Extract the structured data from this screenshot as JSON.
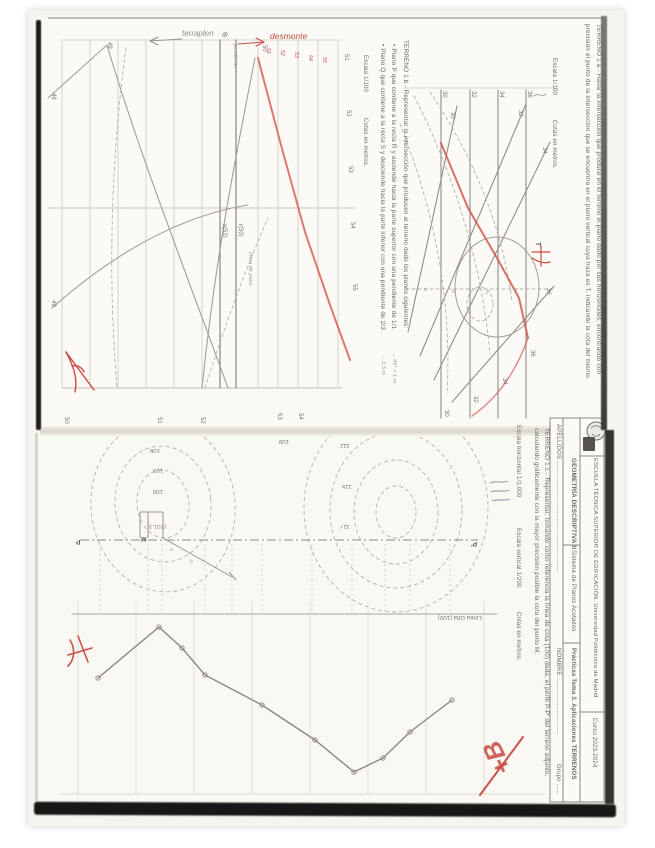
{
  "document": {
    "course_header": {
      "school": "ESCUELA TÉCNICA SUPERIOR DE EDIFICACIÓN. Universidad Politécnica de Madrid",
      "curso": "Curso 2023-2024",
      "subject": "GEOMETRÍA DESCRIPTIVA II",
      "system": "Sistema de Planos Acotados",
      "practice": "Prácticas Tema 3. Aplicaciones TERRENOS",
      "apellidos": "APELLIDOS ............................................................",
      "nombre": "NOMBRE ..............................",
      "grupo": "Grupo ......"
    },
    "terreno_1a": {
      "line1": "TERRENO 1.a.- Hallar la intersección que produce en el terreno el plano dado por sus horizontales, encontrando con",
      "line2": "precisión el punto de la intersección que se encuentra en el plano vertical cuya traza es T, indicando la cota del mismo.",
      "escala": "Escala 1/100",
      "cotas": "Cotas en metros."
    },
    "terreno_1b": {
      "title": "TERRENO 1.b.- Representar la intersección que producen al terreno dado los planos siguientes:",
      "bullet1": "•    Plano P que contiene a la recta R y asciende hacia la parte superior con una pendiente de 1/1",
      "bullet1_note": "→ 45° = 1 m",
      "bullet2": "•    Plano Q que contiene a la recta S y desciende hacia la parte inferior con una pendiente de 2/3",
      "bullet2_note": "→ 1,5 m",
      "escala": "Escala 1/100",
      "cotas": "Cotas en metros."
    },
    "terreno_1c": {
      "line1": "TERRENO 1.c.- Representar, tomando como referencia la línea de cota (100) dada, el perfil P-P' del terreno adjunto,",
      "line2": "calculando gráficamente con la mayor precisión posible la cota del punto M.",
      "escala_h": "Escala horizontal 1/1.000",
      "escala_v": "Escala vertical 1/200",
      "cotas": "Cotas en metros."
    },
    "handwriting": {
      "terraplen": "terraplen",
      "desmonte": "desmonte",
      "grade": "+B"
    },
    "colors": {
      "red_ink": "#c94a41",
      "pencil": "#9a948b",
      "print": "#6e6a63",
      "paper": "#f8f7f2"
    },
    "labels": [
      {
        "t": "48",
        "x": 56,
        "y": 93,
        "c": "v5"
      },
      {
        "t": "49",
        "x": 56,
        "y": 300,
        "c": "v5"
      },
      {
        "t": "49",
        "x": 112,
        "y": 42,
        "c": "v5"
      },
      {
        "t": "50",
        "x": 267,
        "y": 45,
        "c": "v5"
      },
      {
        "t": "51",
        "x": 349,
        "y": 54,
        "c": "v5"
      },
      {
        "t": "52",
        "x": 351,
        "y": 110,
        "c": "v5"
      },
      {
        "t": "53",
        "x": 353,
        "y": 166,
        "c": "v5"
      },
      {
        "t": "54",
        "x": 355,
        "y": 222,
        "c": "v5"
      },
      {
        "t": "55",
        "x": 357,
        "y": 284,
        "c": "v5"
      },
      {
        "t": "50",
        "x": 69,
        "y": 417,
        "c": "v5"
      },
      {
        "t": "51",
        "x": 162,
        "y": 417,
        "c": "v5"
      },
      {
        "t": "52",
        "x": 205,
        "y": 417,
        "c": "v5"
      },
      {
        "t": "53",
        "x": 282,
        "y": 413,
        "c": "v5"
      },
      {
        "t": "54",
        "x": 303,
        "y": 413,
        "c": "v5"
      },
      {
        "t": "s(52)",
        "x": 227,
        "y": 224,
        "c": "v5",
        "n": "line-s52-label"
      },
      {
        "t": "r(50)",
        "x": 243,
        "y": 224,
        "c": "v5",
        "n": "line-r50-label"
      },
      {
        "t": "51",
        "x": 270,
        "y": 48,
        "c": "vr"
      },
      {
        "t": "52",
        "x": 284,
        "y": 50,
        "c": "vr"
      },
      {
        "t": "53",
        "x": 298,
        "y": 52,
        "c": "vr"
      },
      {
        "t": "54",
        "x": 312,
        "y": 55,
        "c": "vr"
      },
      {
        "t": "55",
        "x": 326,
        "y": 57,
        "c": "vr"
      },
      {
        "t": "30",
        "x": 447,
        "y": 91,
        "c": "v5"
      },
      {
        "t": "32",
        "x": 476,
        "y": 91,
        "c": "v5"
      },
      {
        "t": "34",
        "x": 504,
        "y": 91,
        "c": "v5"
      },
      {
        "t": "36",
        "x": 532,
        "y": 91,
        "c": "v5"
      },
      {
        "t": "30",
        "x": 455,
        "y": 112,
        "c": "v5"
      },
      {
        "t": "32",
        "x": 523,
        "y": 110,
        "c": "v5"
      },
      {
        "t": "34",
        "x": 547,
        "y": 147,
        "c": "v5"
      },
      {
        "t": "36",
        "x": 551,
        "y": 288,
        "c": "v5"
      },
      {
        "t": "36",
        "x": 535,
        "y": 350,
        "c": "v5"
      },
      {
        "t": "34",
        "x": 507,
        "y": 378,
        "c": "v5"
      },
      {
        "t": "32",
        "x": 478,
        "y": 396,
        "c": "v5"
      },
      {
        "t": "30",
        "x": 449,
        "y": 410,
        "c": "v5"
      },
      {
        "t": "T",
        "x": 541,
        "y": 242,
        "c": "vb",
        "n": "trace-t-label"
      },
      {
        "t": "a'",
        "x": 424,
        "y": 288,
        "c": "t5"
      },
      {
        "t": "b'",
        "x": 452,
        "y": 290,
        "c": "t5"
      },
      {
        "t": "c'",
        "x": 486,
        "y": 291,
        "c": "t5"
      },
      {
        "t": "d'",
        "x": 514,
        "y": 289,
        "c": "t5"
      },
      {
        "t": "106",
        "x": 150,
        "y": 447,
        "c": "r1",
        "n": "contour-label"
      },
      {
        "t": "103",
        "x": 153,
        "y": 467,
        "c": "r1",
        "n": "contour-label"
      },
      {
        "t": "100",
        "x": 153,
        "y": 488,
        "c": "r1",
        "n": "contour-label"
      },
      {
        "t": "109",
        "x": 279,
        "y": 438,
        "c": "r1",
        "n": "contour-label"
      },
      {
        "t": "112",
        "x": 340,
        "y": 442,
        "c": "r1",
        "n": "contour-label"
      },
      {
        "t": "115",
        "x": 342,
        "y": 483,
        "c": "r1",
        "n": "contour-label"
      },
      {
        "t": "117",
        "x": 340,
        "y": 523,
        "c": "r1",
        "n": "contour-label"
      },
      {
        "t": "P",
        "x": 76,
        "y": 537,
        "c": "r1b",
        "n": "point-p-label"
      },
      {
        "t": "P'",
        "x": 471,
        "y": 539,
        "c": "r1b",
        "n": "point-p-prime-label"
      },
      {
        "t": "M",
        "x": 141,
        "y": 534,
        "c": "r1b",
        "n": "point-m-label"
      },
      {
        "t": "(101,3)",
        "x": 147,
        "y": 523,
        "c": "r1h",
        "n": "cota-m-note"
      },
      {
        "t": "Línea cota (100)",
        "x": 438,
        "y": 614,
        "c": "r1",
        "n": "linea-cota-100-label"
      },
      {
        "t": "⊕",
        "x": 221,
        "y": 31,
        "c": "h",
        "n": "circled-plus-mark"
      },
      {
        "t": "pendiente",
        "x": 237,
        "y": 44,
        "c": "vh",
        "n": "pendiente-note"
      },
      {
        "t": "línea de paso",
        "x": 252,
        "y": 252,
        "c": "vh",
        "n": "linea-de-paso-note"
      },
      {
        "t": "a",
        "x": 170,
        "y": 548,
        "c": "t5"
      },
      {
        "t": "b",
        "x": 190,
        "y": 560,
        "c": "t5"
      }
    ]
  }
}
